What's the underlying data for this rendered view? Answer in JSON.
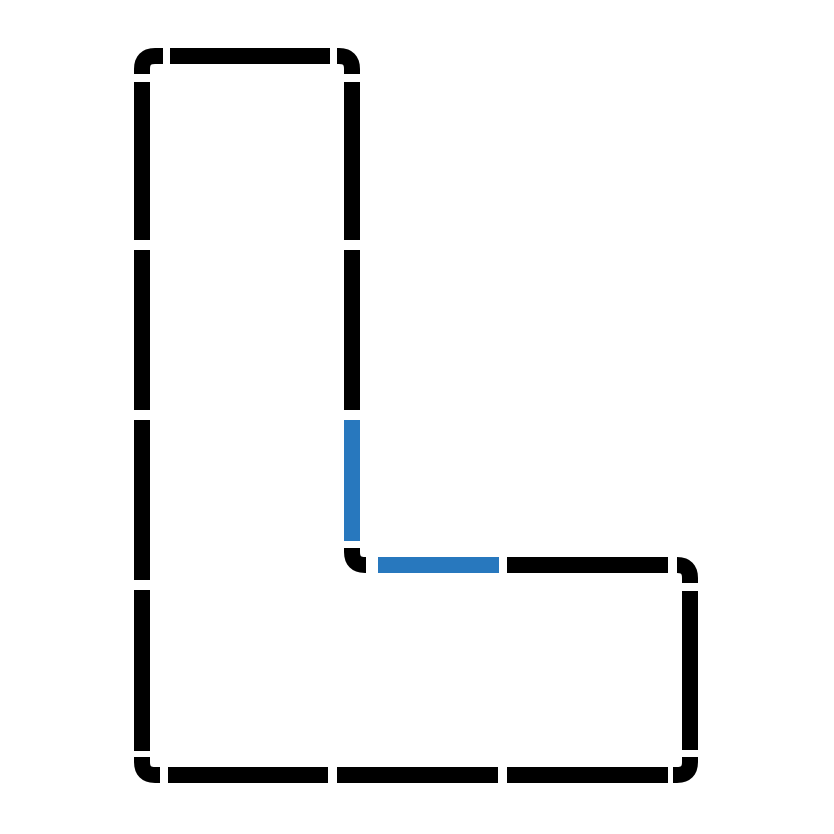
{
  "canvas": {
    "width": 834,
    "height": 834,
    "background": "#ffffff"
  },
  "shape": {
    "description": "dashed-l-outline",
    "stroke_width": 16,
    "corner_radius": 13,
    "colors": {
      "black": "#000000",
      "blue": "#2878be"
    },
    "segments": [
      {
        "id": "corner-top-left",
        "color": "black",
        "path": "M 142 74 L 142 69 Q 142 56 155 56 L 163 56"
      },
      {
        "id": "top-edge-dash",
        "color": "black",
        "path": "M 170 56 L 330 56"
      },
      {
        "id": "corner-stem-top-right",
        "color": "black",
        "path": "M 337 56 L 339 56 Q 352 56 352 69 L 352 74"
      },
      {
        "id": "stem-inner-dash-1",
        "color": "black",
        "path": "M 352 82 L 352 240"
      },
      {
        "id": "stem-inner-dash-2",
        "color": "black",
        "path": "M 352 250 L 352 410"
      },
      {
        "id": "stem-inner-dash-highlight",
        "color": "blue",
        "path": "M 352 420 L 352 541"
      },
      {
        "id": "corner-inner",
        "color": "black",
        "path": "M 352 548 L 352 552 Q 352 565 365 565 L 366 565"
      },
      {
        "id": "foot-top-dash-highlight",
        "color": "blue",
        "path": "M 378 565 L 499 565"
      },
      {
        "id": "foot-top-dash",
        "color": "black",
        "path": "M 507 565 L 668 565"
      },
      {
        "id": "corner-foot-top-right",
        "color": "black",
        "path": "M 677 565 Q 690 565 690 578 L 690 583"
      },
      {
        "id": "right-edge-dash",
        "color": "black",
        "path": "M 690 591 L 690 750"
      },
      {
        "id": "corner-bottom-right",
        "color": "black",
        "path": "M 690 757 L 690 762 Q 690 775 677 775 L 673 775"
      },
      {
        "id": "bottom-edge-dash-1",
        "color": "black",
        "path": "M 668 775 L 507 775"
      },
      {
        "id": "bottom-edge-dash-2",
        "color": "black",
        "path": "M 498 775 L 337 775"
      },
      {
        "id": "bottom-edge-dash-3",
        "color": "black",
        "path": "M 328 775 L 168 775"
      },
      {
        "id": "corner-bottom-left",
        "color": "black",
        "path": "M 160 775 L 155 775 Q 142 775 142 762 L 142 757"
      },
      {
        "id": "left-edge-dash-4",
        "color": "black",
        "path": "M 142 751 L 142 590"
      },
      {
        "id": "left-edge-dash-3",
        "color": "black",
        "path": "M 142 580 L 142 420"
      },
      {
        "id": "left-edge-dash-2",
        "color": "black",
        "path": "M 142 410 L 142 250"
      },
      {
        "id": "left-edge-dash-1",
        "color": "black",
        "path": "M 142 240 L 142 82"
      }
    ]
  }
}
